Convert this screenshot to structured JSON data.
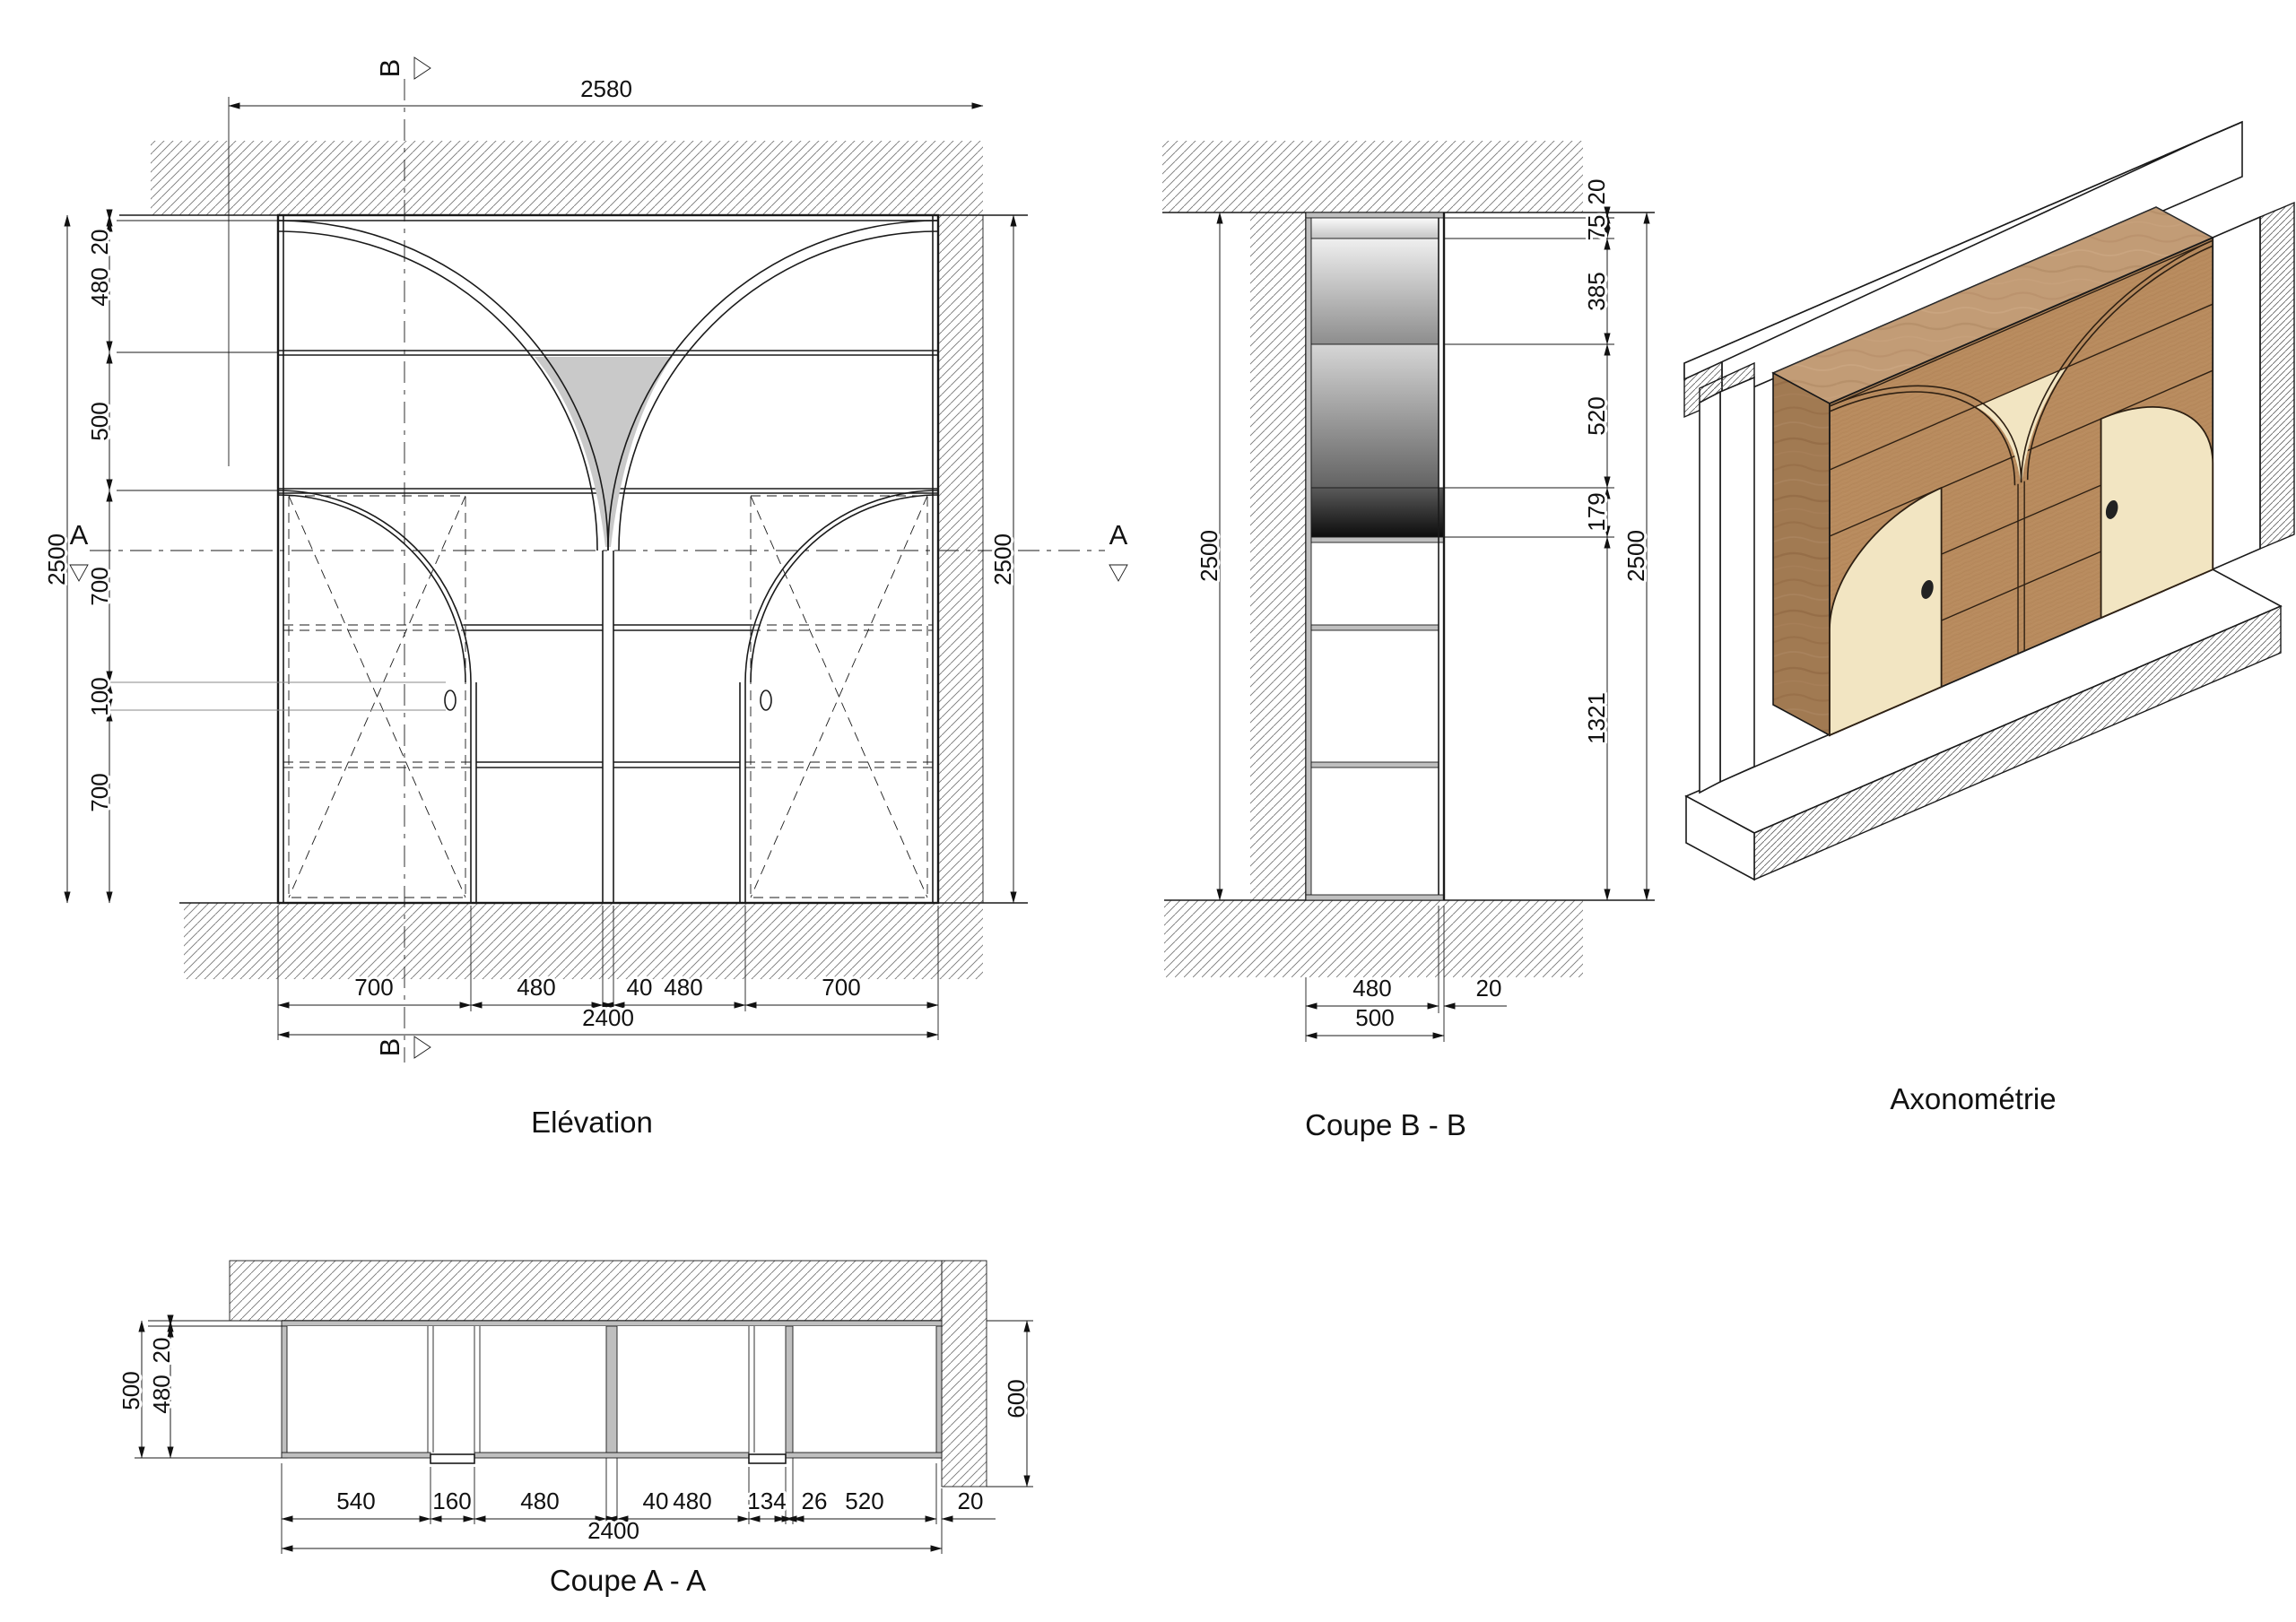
{
  "drawing": {
    "titles": {
      "elevation": "Elévation",
      "coupe_b": "Coupe B - B",
      "axonometrie": "Axonométrie",
      "coupe_a": "Coupe A - A"
    },
    "section_markers": {
      "a": "A",
      "b": "B"
    },
    "colors": {
      "wood": "#b88b5e",
      "wood_side": "#a17750",
      "door_cream": "#f2e5c2",
      "cut_gray": "#bfbfbf",
      "shade_gray": "#c9c9c9",
      "line": "#1a1a1a"
    },
    "elevation": {
      "dim_top_width": "2580",
      "dim_total_height": "2500",
      "left_chain": [
        "20",
        "480",
        "500",
        "700",
        "100",
        "700"
      ],
      "dim_right_height": "2500",
      "bottom_chain": [
        "700",
        "480",
        "40",
        "480",
        "700"
      ],
      "dim_bottom_total": "2400"
    },
    "coupe_b": {
      "dim_left_height": "2500",
      "dim_top": "20",
      "right_chain": [
        "75",
        "385",
        "520",
        "179",
        "1321"
      ],
      "dim_right_total": "2500",
      "dim_depth": "480",
      "dim_front": "20",
      "dim_depth_total": "500"
    },
    "coupe_a": {
      "dim_left_total": "500",
      "left_chain": [
        "20",
        "480"
      ],
      "dim_right_depth": "600",
      "bottom_chain": [
        "540",
        "160",
        "480",
        "40",
        "480",
        "134",
        "26",
        "520"
      ],
      "dim_gap_right": "20",
      "dim_bottom_total": "2400"
    }
  }
}
